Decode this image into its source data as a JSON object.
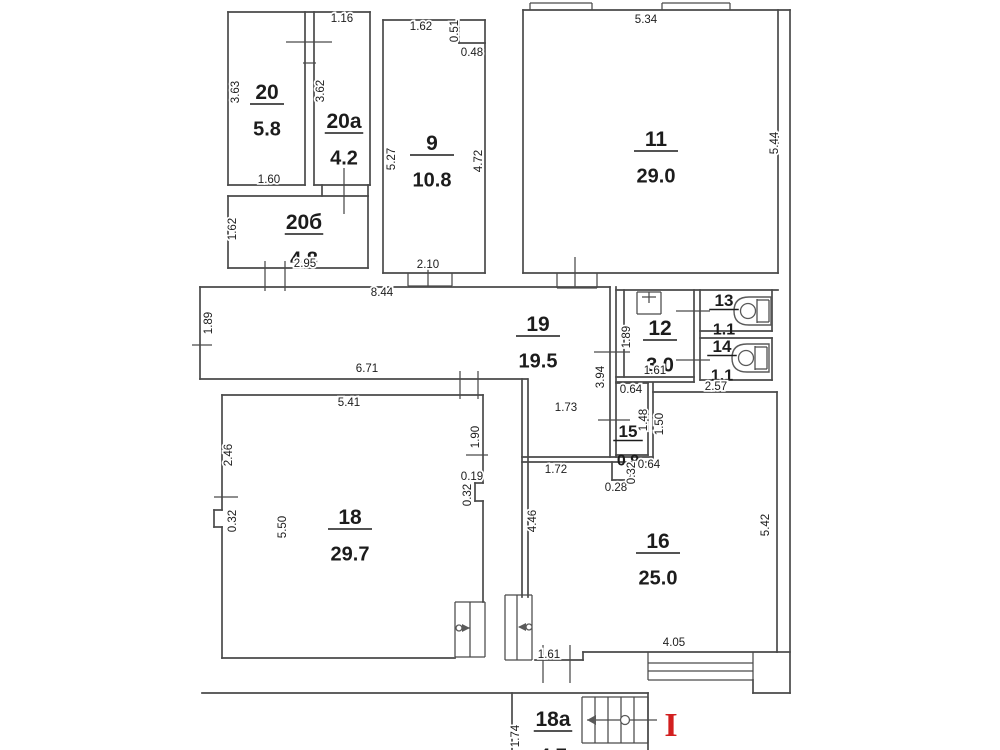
{
  "floorplan": {
    "colors": {
      "wall_line": "#4a4a4a",
      "thin_line": "#5a5a5a",
      "label_text": "#1c1c1c",
      "section_marker_red": "#d21f1f",
      "background": "#ffffff"
    },
    "rooms": [
      {
        "number": "20",
        "area": "5.8",
        "x": 267,
        "y": 99,
        "size": "lg"
      },
      {
        "number": "20a",
        "area": "4.2",
        "x": 344,
        "y": 128,
        "size": "lg"
      },
      {
        "number": "20б",
        "area": "4.8",
        "x": 304,
        "y": 229,
        "size": "lg"
      },
      {
        "number": "9",
        "area": "10.8",
        "x": 432,
        "y": 150,
        "size": "lg"
      },
      {
        "number": "11",
        "area": "29.0",
        "x": 656,
        "y": 146,
        "size": "lg"
      },
      {
        "number": "19",
        "area": "19.5",
        "x": 538,
        "y": 331,
        "size": "lg"
      },
      {
        "number": "12",
        "area": "3.0",
        "x": 660,
        "y": 335,
        "size": "lg"
      },
      {
        "number": "13",
        "area": "1.1",
        "x": 724,
        "y": 306,
        "size": "sm"
      },
      {
        "number": "14",
        "area": "1.1",
        "x": 722,
        "y": 352,
        "size": "sm"
      },
      {
        "number": "15",
        "area": "0.9",
        "x": 628,
        "y": 437,
        "size": "sm"
      },
      {
        "number": "16",
        "area": "25.0",
        "x": 658,
        "y": 548,
        "size": "lg"
      },
      {
        "number": "18",
        "area": "29.7",
        "x": 350,
        "y": 524,
        "size": "lg"
      },
      {
        "number": "18a",
        "area": "4.7",
        "x": 553,
        "y": 726,
        "size": "lg"
      }
    ],
    "dimensions": [
      {
        "value": "1.16",
        "x": 342,
        "y": 19,
        "rot": 0
      },
      {
        "value": "3.63",
        "x": 236,
        "y": 92,
        "rot": 1
      },
      {
        "value": "3.62",
        "x": 321,
        "y": 91,
        "rot": 1
      },
      {
        "value": "1.60",
        "x": 269,
        "y": 180,
        "rot": 0
      },
      {
        "value": "1.62",
        "x": 233,
        "y": 229,
        "rot": 1
      },
      {
        "value": "2.95",
        "x": 305,
        "y": 264,
        "rot": 0
      },
      {
        "value": "1.62",
        "x": 421,
        "y": 27,
        "rot": 0
      },
      {
        "value": "0.51",
        "x": 455,
        "y": 31,
        "rot": 1
      },
      {
        "value": "0.48",
        "x": 472,
        "y": 53,
        "rot": 0
      },
      {
        "value": "5.27",
        "x": 392,
        "y": 159,
        "rot": 1
      },
      {
        "value": "4.72",
        "x": 479,
        "y": 161,
        "rot": 1
      },
      {
        "value": "2.10",
        "x": 428,
        "y": 265,
        "rot": 0
      },
      {
        "value": "5.34",
        "x": 646,
        "y": 20,
        "rot": 0
      },
      {
        "value": "5.44",
        "x": 775,
        "y": 143,
        "rot": 1
      },
      {
        "value": "8.44",
        "x": 382,
        "y": 293,
        "rot": 0
      },
      {
        "value": "1.89",
        "x": 209,
        "y": 323,
        "rot": 1
      },
      {
        "value": "6.71",
        "x": 367,
        "y": 369,
        "rot": 0
      },
      {
        "value": "1.89",
        "x": 627,
        "y": 337,
        "rot": 1
      },
      {
        "value": "3.94",
        "x": 601,
        "y": 377,
        "rot": 1
      },
      {
        "value": "1.61",
        "x": 655,
        "y": 371,
        "rot": 0
      },
      {
        "value": "2.57",
        "x": 716,
        "y": 387,
        "rot": 0
      },
      {
        "value": "0.64",
        "x": 631,
        "y": 390,
        "rot": 0
      },
      {
        "value": "1.48",
        "x": 644,
        "y": 420,
        "rot": 1
      },
      {
        "value": "1.50",
        "x": 660,
        "y": 424,
        "rot": 1
      },
      {
        "value": "1.73",
        "x": 566,
        "y": 408,
        "rot": 0
      },
      {
        "value": "1.72",
        "x": 556,
        "y": 470,
        "rot": 0
      },
      {
        "value": "0.28",
        "x": 616,
        "y": 488,
        "rot": 0
      },
      {
        "value": "0.32",
        "x": 632,
        "y": 473,
        "rot": 1
      },
      {
        "value": "0.64",
        "x": 649,
        "y": 465,
        "rot": 0
      },
      {
        "value": "5.41",
        "x": 349,
        "y": 403,
        "rot": 0
      },
      {
        "value": "2.46",
        "x": 229,
        "y": 455,
        "rot": 1
      },
      {
        "value": "1.90",
        "x": 476,
        "y": 437,
        "rot": 1
      },
      {
        "value": "0.19",
        "x": 472,
        "y": 477,
        "rot": 0
      },
      {
        "value": "0.32",
        "x": 468,
        "y": 495,
        "rot": 1
      },
      {
        "value": "0.32",
        "x": 233,
        "y": 521,
        "rot": 1
      },
      {
        "value": "5.50",
        "x": 283,
        "y": 527,
        "rot": 1
      },
      {
        "value": "4.46",
        "x": 533,
        "y": 521,
        "rot": 1
      },
      {
        "value": "5.42",
        "x": 766,
        "y": 525,
        "rot": 1
      },
      {
        "value": "4.05",
        "x": 674,
        "y": 643,
        "rot": 0
      },
      {
        "value": "1.61",
        "x": 549,
        "y": 655,
        "rot": 0
      },
      {
        "value": "1.74",
        "x": 516,
        "y": 736,
        "rot": 1
      }
    ],
    "section_marker": {
      "text": "I",
      "x": 671,
      "y": 736
    }
  }
}
